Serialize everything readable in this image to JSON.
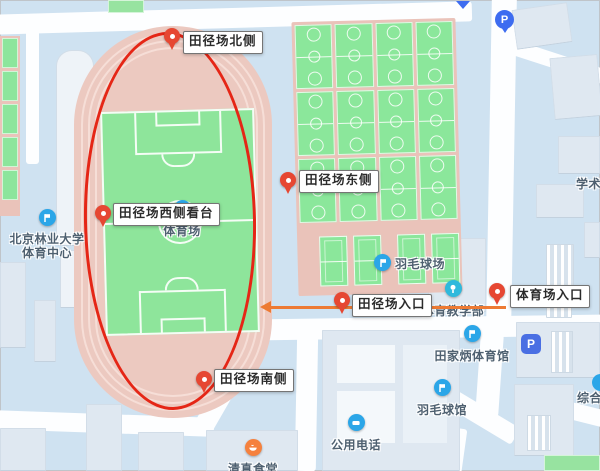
{
  "annotations": {
    "ellipse_color": "#e52616",
    "arrow_color": "#ed7a33",
    "pin_color": "#e64732"
  },
  "markers": [
    {
      "id": "track-north",
      "label": "田径场北侧"
    },
    {
      "id": "track-east",
      "label": "田径场东侧"
    },
    {
      "id": "track-west-stand",
      "label": "田径场西侧看台"
    },
    {
      "id": "track-south",
      "label": "田径场南侧"
    },
    {
      "id": "track-entrance",
      "label": "田径场入口"
    },
    {
      "id": "stadium-entrance",
      "label": "体育场入口"
    }
  ],
  "pois": [
    {
      "id": "bfu-sports-center",
      "line1": "北京林业大学",
      "line2": "体育中心",
      "icon_color": "#2ba6e8"
    },
    {
      "id": "stadium",
      "label": "体育场",
      "icon_color": "#2ba6e8"
    },
    {
      "id": "badminton-courts",
      "label": "羽毛球场",
      "icon_color": "#2ba6e8"
    },
    {
      "id": "pe-teaching-dept",
      "label": "体育教学部",
      "icon_color": "#2fb9dc"
    },
    {
      "id": "tianjiabing-gym",
      "label": "田家炳体育馆",
      "icon_color": "#2ba6e8"
    },
    {
      "id": "badminton-hall",
      "label": "羽毛球馆",
      "icon_color": "#2ba6e8"
    },
    {
      "id": "public-phone",
      "label": "公用电话",
      "icon_color": "#2ba6e8"
    },
    {
      "id": "halal-canteen",
      "label": "清真食堂",
      "icon_color": "#f5813e"
    }
  ],
  "area_labels": [
    {
      "id": "academic",
      "text": "学术"
    },
    {
      "id": "complex",
      "text": "综合"
    }
  ],
  "parking": {
    "pin_label": "P",
    "lot_label": "P"
  }
}
